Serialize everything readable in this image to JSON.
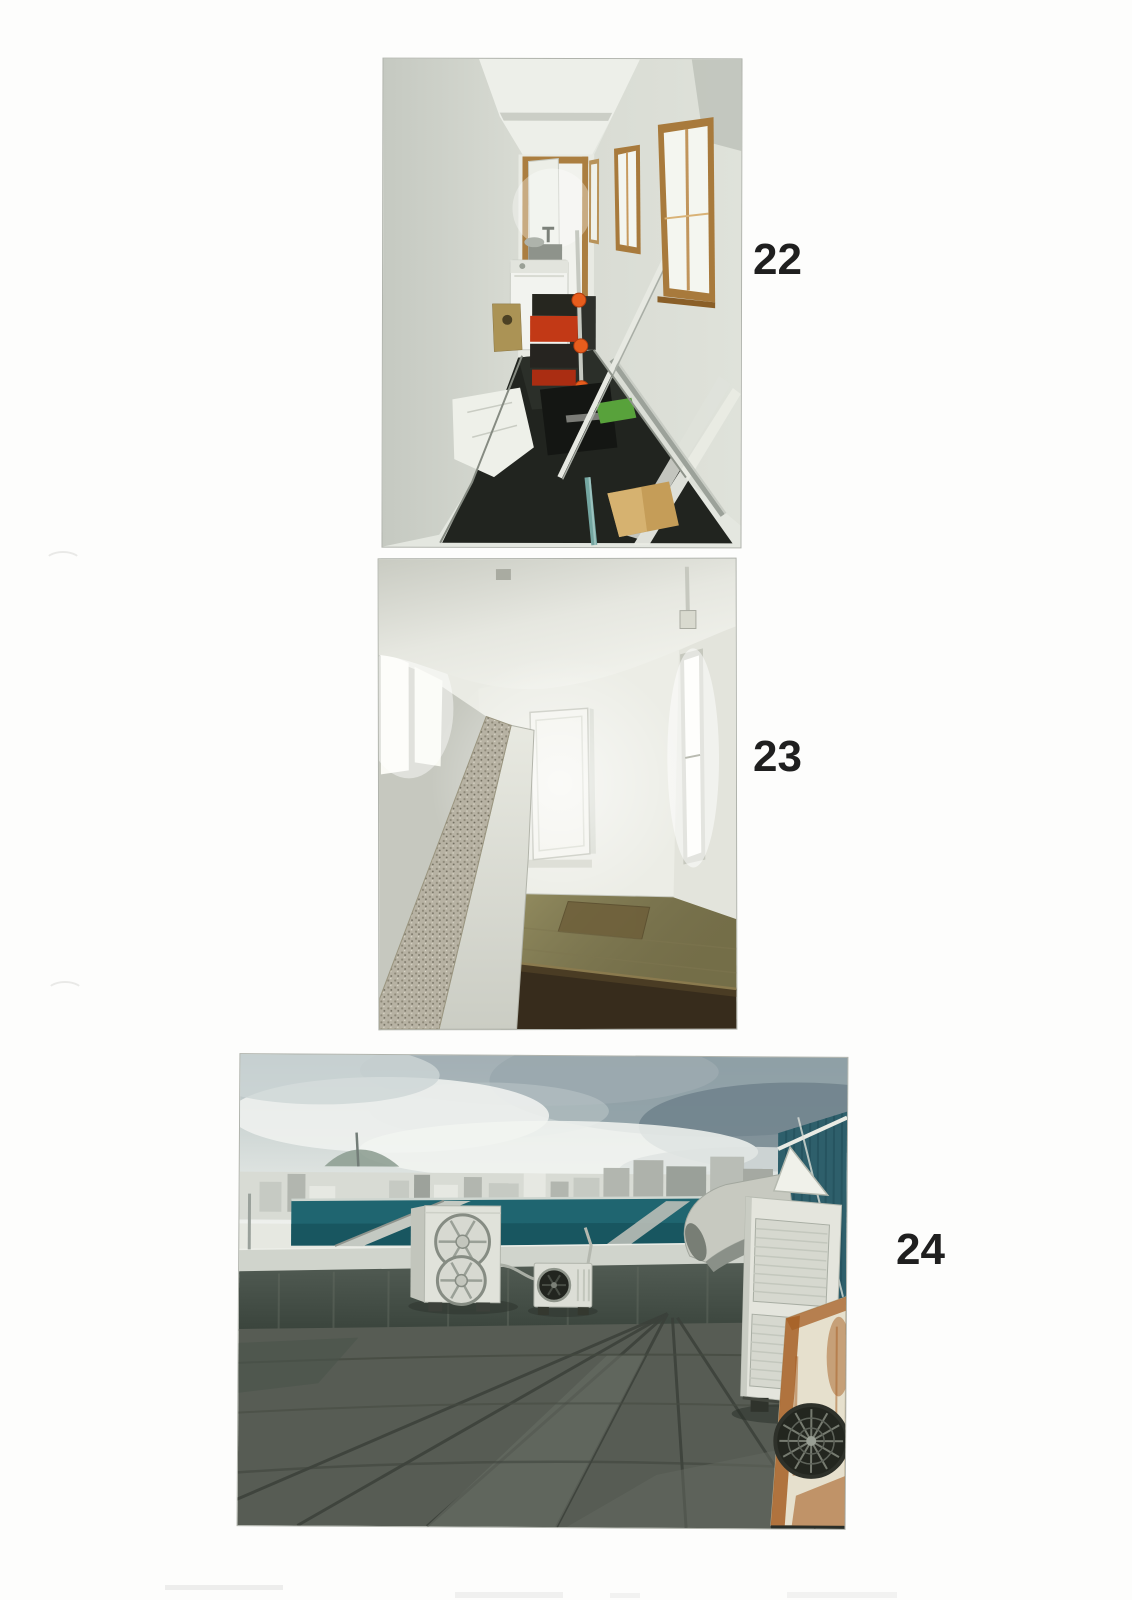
{
  "photos": [
    {
      "label": "22"
    },
    {
      "label": "23"
    },
    {
      "label": "24"
    }
  ],
  "palette": {
    "page_background": "#fdfdfc",
    "label_color": "#1f1f1f",
    "wood_frame": "#a87a3c",
    "corridor_floor_dark": "#21241f",
    "attic_floor": "#979062",
    "teal_roof_band": "#1f6570",
    "teal_building": "#2e5f6b",
    "rust": "#a65f24"
  }
}
